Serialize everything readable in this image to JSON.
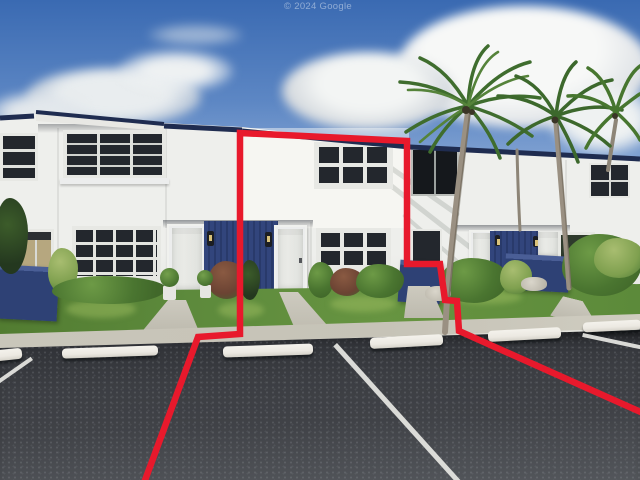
{
  "watermark": {
    "text": "© 2024 Google"
  },
  "colors": {
    "outline-red": "#e8192c",
    "roof-navy": "#1f2c50",
    "panel-navy": "#32457c",
    "panel-navy-dark": "#293a6b",
    "accent-wall-navy": "#2e4175",
    "sky-top": "#3a6ab2",
    "sky-low": "#8fadd8",
    "wall-white": "#eeefec",
    "door-white": "#e9eae6",
    "grass": "#5d8a3c",
    "grass-dark": "#41682a",
    "concrete": "#c6c3b7",
    "asphalt": "#404247",
    "curb-white": "#ece9e2",
    "palm-green": "#4a7a33",
    "trunk-gray": "#9a9082"
  }
}
